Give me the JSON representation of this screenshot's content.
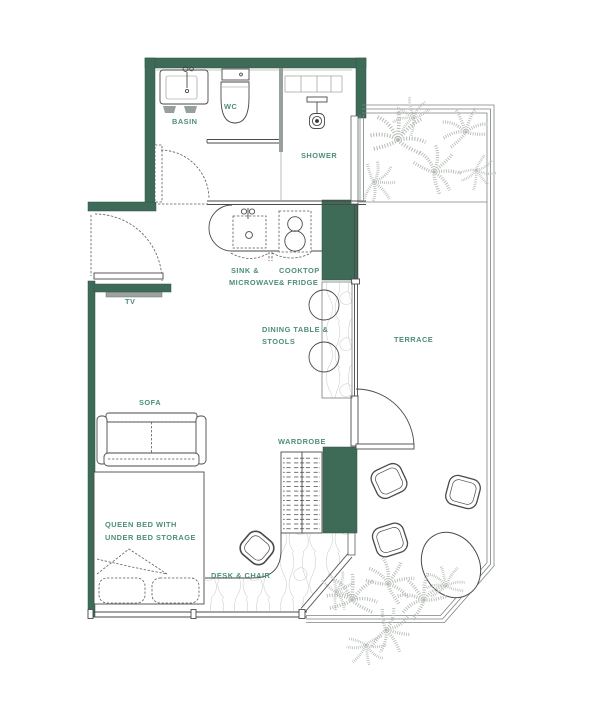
{
  "app": {
    "type": "studio-apartment-floor-plan"
  },
  "colors": {
    "wall": "#3E6A58",
    "label": "#4E8E76",
    "line": "#4A4A4A",
    "wood": "#CDD2CD",
    "plant": "#B5BBB5",
    "tv": "#9BA3A0"
  },
  "labels": {
    "basin": "BASIN",
    "wc": "WC",
    "shower": "SHOWER",
    "sink": [
      "SINK &",
      "MICROWAVE"
    ],
    "cooktop": [
      "COOKTOP",
      "& FRIDGE"
    ],
    "tv": "TV",
    "dining": [
      "DINING TABLE &",
      "STOOLS"
    ],
    "terrace": "TERRACE",
    "sofa": "SOFA",
    "wardrobe": "WARDROBE",
    "bed": [
      "QUEEN BED WITH",
      "UNDER BED STORAGE"
    ],
    "desk": "DESK & CHAIR"
  }
}
